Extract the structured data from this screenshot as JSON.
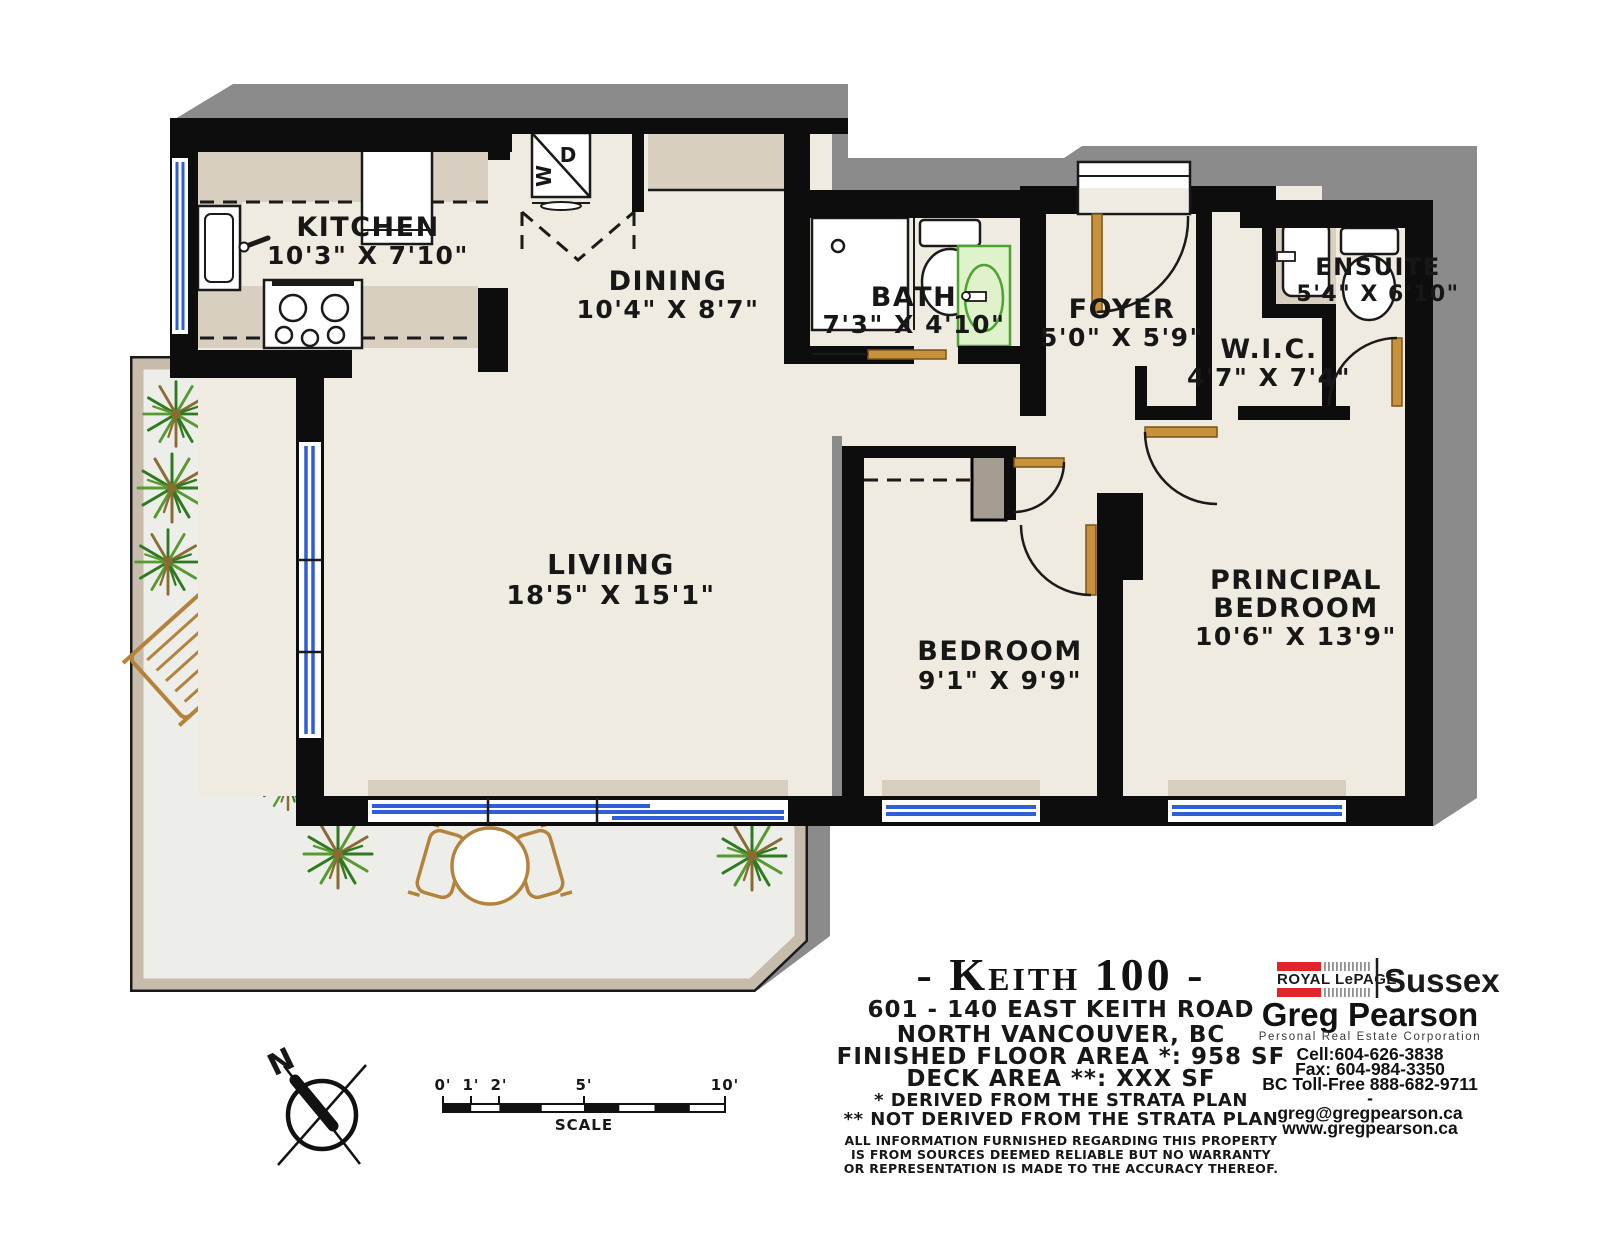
{
  "rooms": {
    "kitchen": {
      "name": "KITCHEN",
      "dims": "10'3\" X 7'10\""
    },
    "dining": {
      "name": "DINING",
      "dims": "10'4\" X 8'7\""
    },
    "bath": {
      "name": "BATH",
      "dims": "7'3\" X 4'10\""
    },
    "foyer": {
      "name": "FOYER",
      "dims": "5'0\" X 5'9\""
    },
    "wic": {
      "name": "W.I.C.",
      "dims": "4'7\" X 7'4\""
    },
    "ensuite": {
      "name": "ENSUITE",
      "dims": "5'4\" X 6'10\""
    },
    "living": {
      "name": "LIVIING",
      "dims": "18'5\" X 15'1\""
    },
    "bedroom": {
      "name": "BEDROOM",
      "dims": "9'1\" X 9'9\""
    },
    "principal": {
      "name_line1": "PRINCIPAL",
      "name_line2": "BEDROOM",
      "dims": "10'6\" X 13'9\""
    }
  },
  "laundry": {
    "washer": "W",
    "dryer": "D"
  },
  "title_block": {
    "title": "- Keith 100 -",
    "address": "601 - 140 EAST KEITH ROAD",
    "city": "NORTH VANCOUVER, BC",
    "floor_area": "FINISHED FLOOR AREA *: 958 SF",
    "deck_area": "DECK AREA **: XXX SF",
    "note1": "* DERIVED FROM THE STRATA PLAN",
    "note2": "** NOT DERIVED FROM THE STRATA PLAN",
    "disclaimer1": "ALL INFORMATION FURNISHED REGARDING THIS PROPERTY",
    "disclaimer2": "IS FROM SOURCES DEEMED RELIABLE BUT NO WARRANTY",
    "disclaimer3": "OR REPRESENTATION IS MADE TO THE ACCURACY THEREOF."
  },
  "brokerage": {
    "brand_left": "ROYAL LePAGE",
    "brand_right": "Sussex",
    "agent": "Greg Pearson",
    "agent_sub": "Personal Real Estate Corporation",
    "cell": "Cell:604-626-3838",
    "fax": "Fax: 604-984-3350",
    "tollfree": "BC Toll-Free 888-682-9711",
    "dash": "-",
    "email": "greg@gregpearson.ca",
    "website": "www.gregpearson.ca"
  },
  "scale_bar": {
    "labels": [
      "0'",
      "1'",
      "2'",
      "5'",
      "10'"
    ],
    "caption": "SCALE"
  },
  "compass": {
    "north": "N"
  },
  "colors": {
    "wall_black": "#0d0d0d",
    "floor_cream": "#efebe0",
    "counter_beige": "#d8cfc0",
    "closet_gray": "#a59d91",
    "deck_floor": "#ededea",
    "deck_trim": "#c7bcac",
    "shadow_gray": "#8b8b8b",
    "window_blue": "#2e5fd7",
    "door_tan": "#c8913b",
    "vanity_green": "#4ca32f",
    "plant_green": "#2e7a1e",
    "royal_lepage_red": "#e1252b"
  }
}
